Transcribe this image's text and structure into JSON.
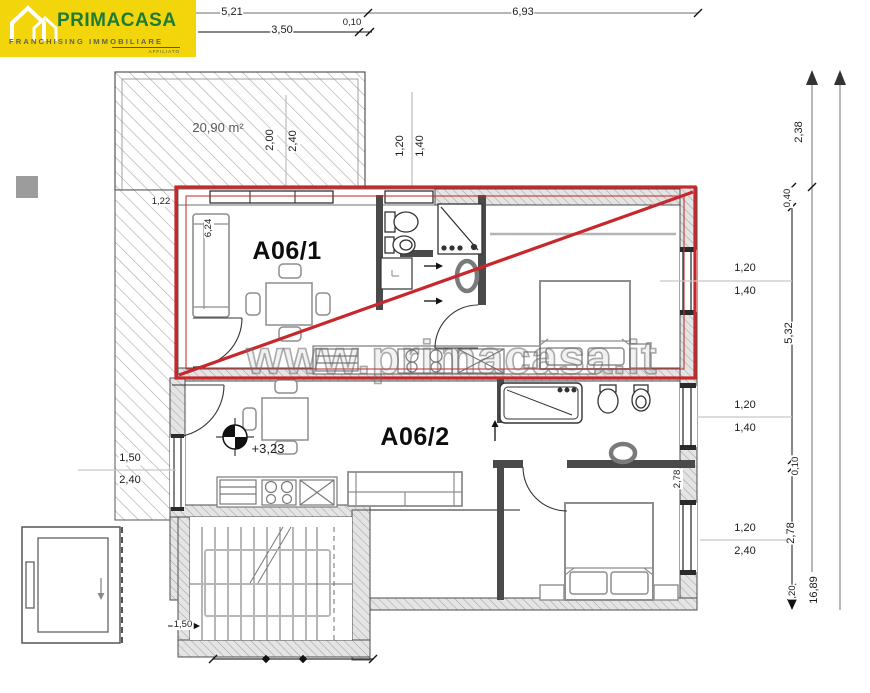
{
  "colors": {
    "accent_red": "#c8272c",
    "logo_yellow": "#f2d50a",
    "logo_green": "#1e7b37",
    "wall_gray": "#9f9f9f",
    "furniture_gray": "#8e8e8e"
  },
  "logo": {
    "brand": "PRIMACASA",
    "subtitle": "FRANCHISING IMMOBILIARE",
    "affiliate": "AFFILIATO"
  },
  "watermark": {
    "text": "www.primacasa.it"
  },
  "labels": [
    {
      "name": "dim-top-5-21",
      "text": "5,21",
      "x": 232,
      "y": 13,
      "rot": 0,
      "cls": "dim"
    },
    {
      "name": "dim-top-0-10",
      "text": "0,10",
      "x": 352,
      "y": 23,
      "rot": 0,
      "cls": "dim-sm"
    },
    {
      "name": "dim-top-6-93",
      "text": "6,93",
      "x": 523,
      "y": 13,
      "rot": 0,
      "cls": "dim"
    },
    {
      "name": "dim-top-3-50",
      "text": "3,50",
      "x": 282,
      "y": 31,
      "rot": 0,
      "cls": "dim"
    },
    {
      "name": "terrace-area-label",
      "text": "20,90 m²",
      "x": 218,
      "y": 128,
      "rot": 0,
      "cls": "area"
    },
    {
      "name": "dim-terrace-2-00",
      "text": "2,00",
      "x": 271,
      "y": 140,
      "rot": -90,
      "cls": "dim"
    },
    {
      "name": "dim-terrace-2-40",
      "text": "2,40",
      "x": 294,
      "y": 141,
      "rot": -90,
      "cls": "dim"
    },
    {
      "name": "dim-terrace-1-22",
      "text": "1,22",
      "x": 161,
      "y": 202,
      "rot": 0,
      "cls": "dim-sm"
    },
    {
      "name": "dim-bath-1-20",
      "text": "1,20",
      "x": 401,
      "y": 146,
      "rot": -90,
      "cls": "dim"
    },
    {
      "name": "dim-bath-1-40",
      "text": "1,40",
      "x": 421,
      "y": 146,
      "rot": -90,
      "cls": "dim"
    },
    {
      "name": "dim-sofa-6-24",
      "text": "6,24",
      "x": 209,
      "y": 228,
      "rot": -90,
      "cls": "dim-sm"
    },
    {
      "name": "room-label-a06-1",
      "text": "A06/1",
      "x": 287,
      "y": 251,
      "rot": 0,
      "cls": "room"
    },
    {
      "name": "room-label-a06-2",
      "text": "A06/2",
      "x": 415,
      "y": 437,
      "rot": 0,
      "cls": "room"
    },
    {
      "name": "level-marker-label",
      "text": "+3,23",
      "x": 268,
      "y": 449,
      "rot": 0,
      "cls": "level"
    },
    {
      "name": "dim-win1-1-20",
      "text": "1,20",
      "x": 745,
      "y": 269,
      "rot": 0,
      "cls": "dim"
    },
    {
      "name": "dim-win1-1-40",
      "text": "1,40",
      "x": 745,
      "y": 292,
      "rot": 0,
      "cls": "dim"
    },
    {
      "name": "dim-win2-1-20",
      "text": "1,20",
      "x": 745,
      "y": 406,
      "rot": 0,
      "cls": "dim"
    },
    {
      "name": "dim-win2-1-40",
      "text": "1,40",
      "x": 745,
      "y": 429,
      "rot": 0,
      "cls": "dim"
    },
    {
      "name": "dim-win3-1-20",
      "text": "1,20",
      "x": 745,
      "y": 529,
      "rot": 0,
      "cls": "dim"
    },
    {
      "name": "dim-win3-2-40",
      "text": "2,40",
      "x": 745,
      "y": 552,
      "rot": 0,
      "cls": "dim"
    },
    {
      "name": "dim-right-2-38",
      "text": "2,38",
      "x": 800,
      "y": 132,
      "rot": -90,
      "cls": "dim"
    },
    {
      "name": "dim-right-0-40",
      "text": "0,40",
      "x": 788,
      "y": 198,
      "rot": -90,
      "cls": "dim-sm"
    },
    {
      "name": "dim-right-5-32",
      "text": "5,32",
      "x": 790,
      "y": 333,
      "rot": -90,
      "cls": "dim"
    },
    {
      "name": "dim-right-0-10",
      "text": "0,10",
      "x": 796,
      "y": 466,
      "rot": -90,
      "cls": "dim-sm"
    },
    {
      "name": "dim-right-2-78",
      "text": "2,78",
      "x": 792,
      "y": 533,
      "rot": -90,
      "cls": "dim"
    },
    {
      "name": "dim-right-0-20",
      "text": ",20",
      "x": 793,
      "y": 592,
      "rot": -90,
      "cls": "dim-sm"
    },
    {
      "name": "dim-right-16-89",
      "text": "16,89",
      "x": 815,
      "y": 590,
      "rot": -90,
      "cls": "dim"
    },
    {
      "name": "dim-bed-2-78",
      "text": "2,78",
      "x": 678,
      "y": 479,
      "rot": -90,
      "cls": "dim-sm"
    },
    {
      "name": "dim-leftwin-1-50",
      "text": "1,50",
      "x": 130,
      "y": 459,
      "rot": 0,
      "cls": "dim"
    },
    {
      "name": "dim-leftwin-2-40",
      "text": "2,40",
      "x": 130,
      "y": 481,
      "rot": 0,
      "cls": "dim"
    },
    {
      "name": "dim-stairs-1-50",
      "text": "1,50",
      "x": 183,
      "y": 625,
      "rot": 0,
      "cls": "dim-sm"
    }
  ]
}
